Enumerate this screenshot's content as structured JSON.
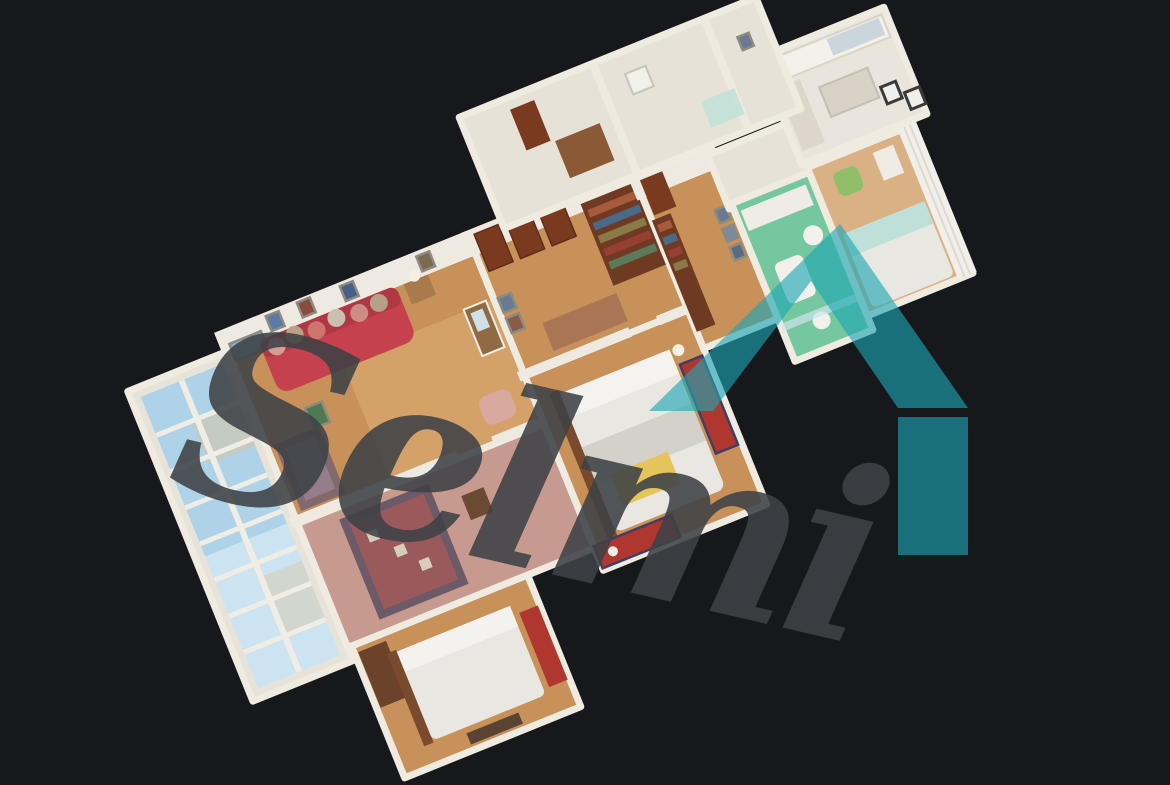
{
  "watermark": {
    "text": "Selmi"
  },
  "logo": {
    "shape": "house-roof-monogram"
  },
  "colors": {
    "background": "#17181B",
    "logo_teal": "#1BA7B4",
    "watermark_gray": "#3E4246",
    "sky_blue": "#AED3E8",
    "wall_white": "#EEEAE1",
    "parquet_wood": "#C8915A",
    "carpet_pink": "#C79A90",
    "sofa_red": "#C4414D",
    "rug_red": "#B0372F",
    "runner_rug": "#9A5A5C",
    "bathroom_green": "#74C79E",
    "door_wood": "#793A20",
    "bookshelf_wood": "#6F3A22",
    "bed_linen": "#E9E7E2",
    "blanket_yellow": "#E5C55A",
    "curtain_white": "#F1EFE9",
    "kitchen_white": "#E9E5DC"
  }
}
